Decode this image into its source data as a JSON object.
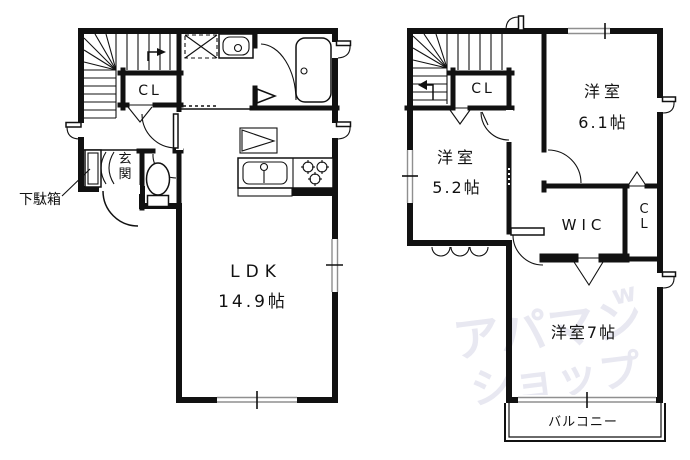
{
  "watermark": {
    "line1": "アパマン",
    "line2": "ショップ",
    "accent": "w",
    "color": "#e8e8f1"
  },
  "colors": {
    "wall": "#111111",
    "window_line": "#8f8f8f",
    "background": "#ffffff"
  },
  "floor1": {
    "labels": {
      "shoe_cabinet": "下駄箱",
      "closet": "CL",
      "entrance": [
        "玄",
        "関"
      ],
      "ldk": "LDK",
      "ldk_area": "14.9帖"
    }
  },
  "floor2": {
    "labels": {
      "closet": "CL",
      "west_room_a": "洋室",
      "west_room_a_area": "5.2帖",
      "west_room_b": "洋室",
      "west_room_b_area": "6.1帖",
      "wic": "WIC",
      "closet_side": [
        "C",
        "L"
      ],
      "west_room_c": "洋室7帖",
      "balcony": "バルコニー"
    }
  }
}
